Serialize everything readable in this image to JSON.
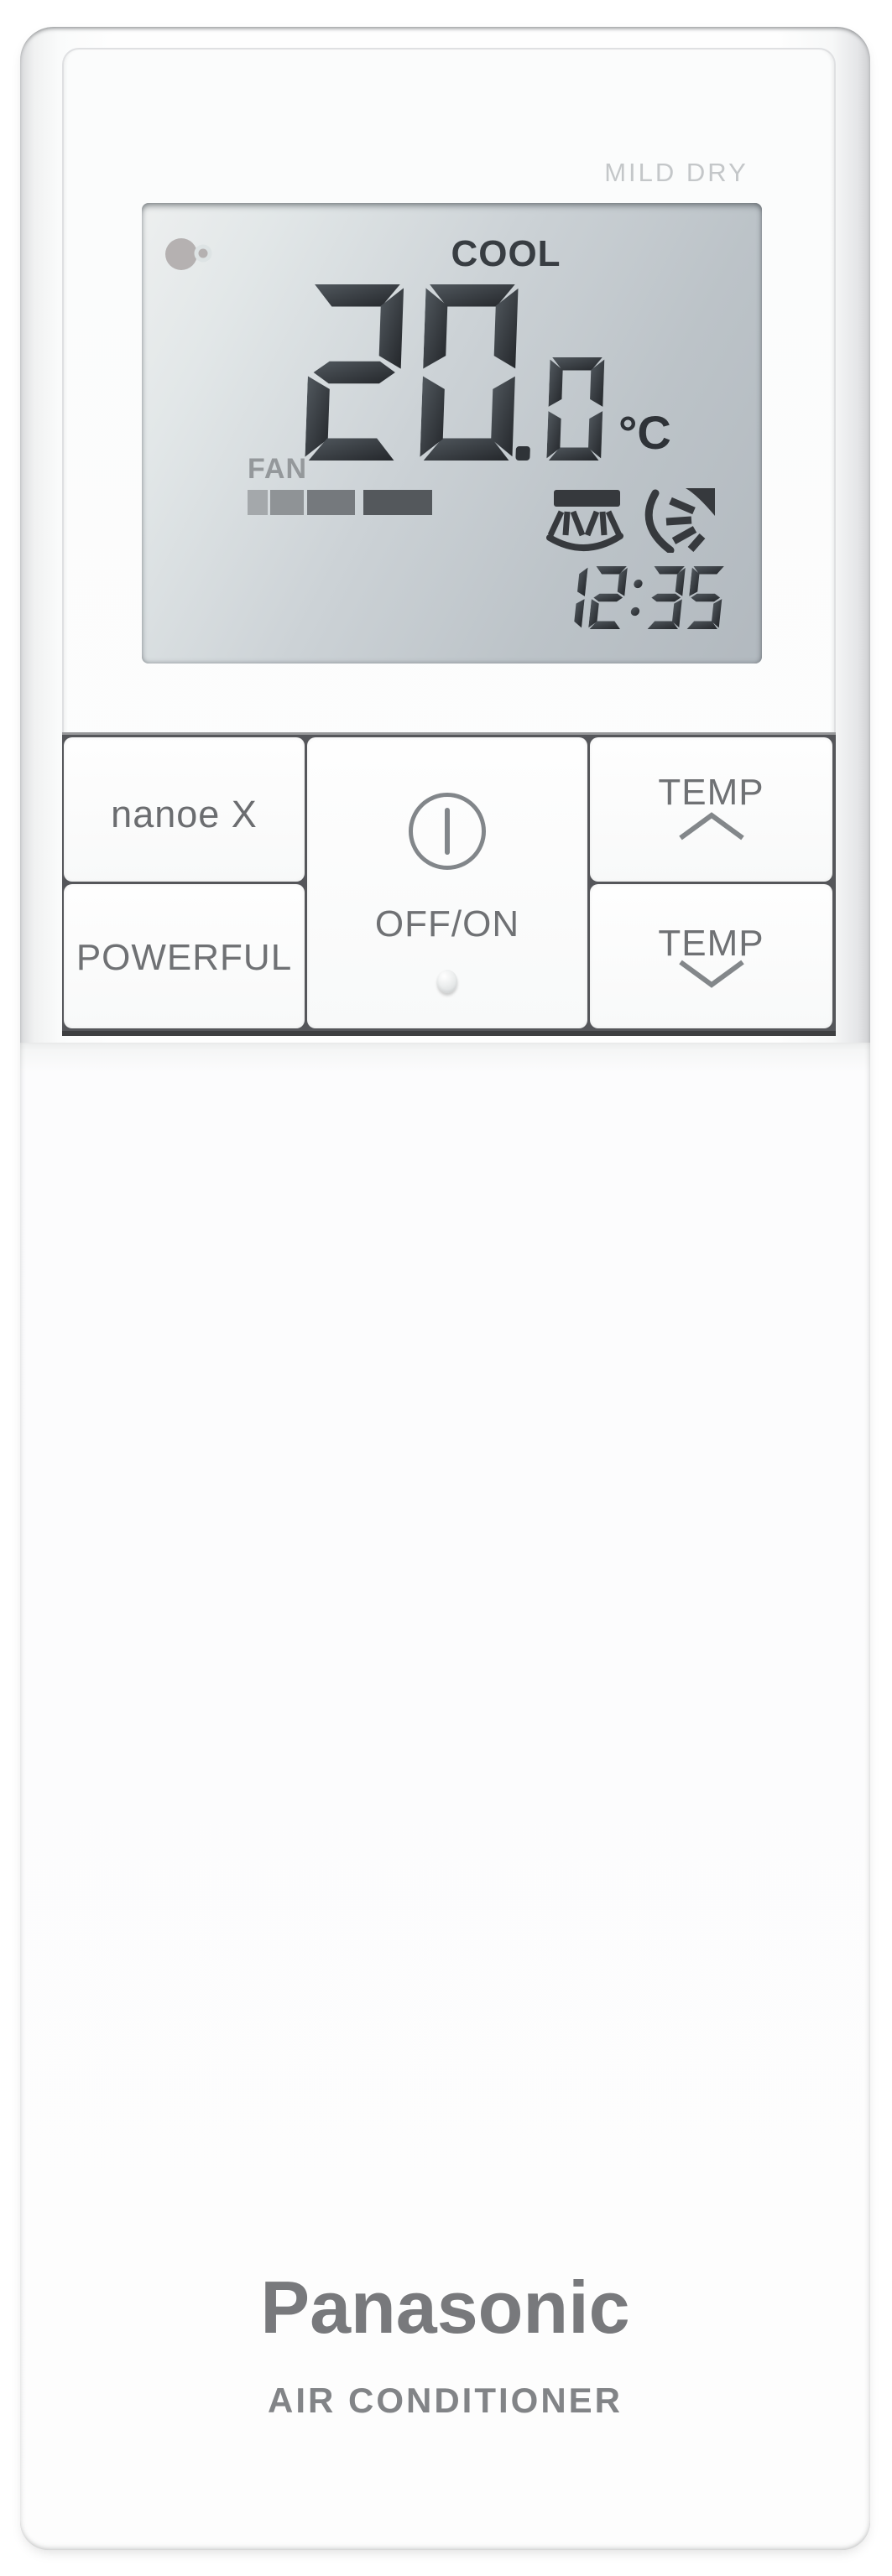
{
  "branding": {
    "brand": "Panasonic",
    "product": "AIR CONDITIONER"
  },
  "device": {
    "panel_label": "MILD DRY"
  },
  "display": {
    "mode": "COOL",
    "temperature": "20.0",
    "temperature_unit": "°C",
    "fan_label": "FAN",
    "fan_level": 4,
    "time": "12:35",
    "icons": {
      "nanoe": "nanoe-icon",
      "swing_vertical": "vertical-airflow-swing-icon",
      "swing_horizontal": "horizontal-airflow-swing-icon"
    }
  },
  "buttons": {
    "nanoe_label": "nanoe X",
    "powerful_label": "POWERFUL",
    "power_label": "OFF/ON",
    "temp_up_label": "TEMP",
    "temp_down_label": "TEMP"
  },
  "colors": {
    "lcd_segment": "#33373c",
    "lcd_segment_light": "#51585e",
    "lcd_segment_dark": "#24272b",
    "lcd_icon": "#36393d",
    "label_gray": "#6f7174",
    "mild_dry_gray": "#c4c7c9",
    "fan_bar_colors": [
      "#a4a8ab",
      "#8f9396",
      "#75797d",
      "#54585c"
    ]
  }
}
